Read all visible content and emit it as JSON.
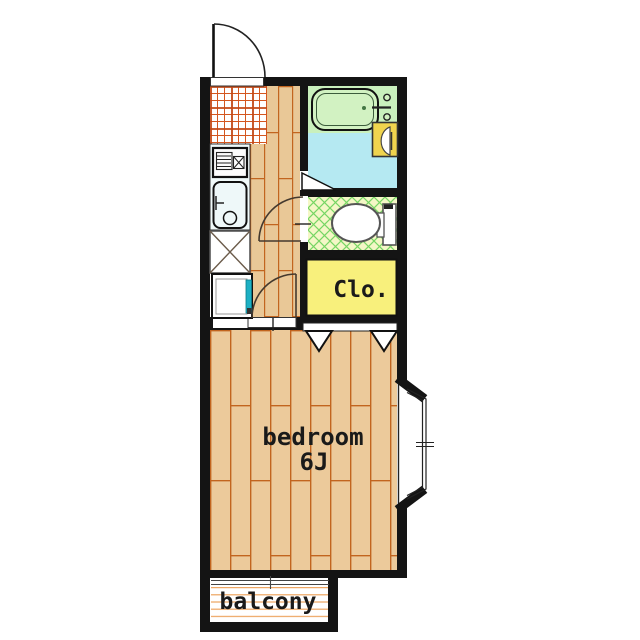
{
  "floor_plan": {
    "labels": {
      "bedroom_name": "bedroom",
      "bedroom_size": "6J",
      "closet": "Clo.",
      "balcony": "balcony"
    },
    "rooms": [
      {
        "name": "kitchen",
        "floor": "red tile grid"
      },
      {
        "name": "hallway",
        "floor": "wood planks"
      },
      {
        "name": "bathroom",
        "floor": "green / light blue"
      },
      {
        "name": "toilet-room",
        "floor": "green cross-hatch"
      },
      {
        "name": "closet",
        "label": "Clo.",
        "floor": "yellow"
      },
      {
        "name": "bedroom",
        "label": "bedroom 6J",
        "floor": "wood planks"
      },
      {
        "name": "balcony",
        "label": "balcony",
        "floor": "lined decking"
      }
    ],
    "fixtures": [
      "entrance-door",
      "bathtub",
      "bath-faucet",
      "washbasin",
      "toilet",
      "stove",
      "kitchen-sink",
      "refrigerator-space",
      "washing-machine-pan",
      "bay-window",
      "sliding-door",
      "closet-doors",
      "toilet-door",
      "bedroom-door",
      "bath-door"
    ],
    "colors": {
      "wall": "#141414",
      "wood_floor": "#ecca9b",
      "wood_seam": "#c2651f",
      "kitchen_tile_line": "#d4571f",
      "bath_floor": "#c9f0bd",
      "bathtub_fill": "#d2f2c2",
      "washroom_floor": "#b5e9f2",
      "toilet_floor": "#f4f7c6",
      "toilet_hatch": "#76d663",
      "closet_fill": "#f8f07c",
      "basin_fill": "#f0d44e",
      "washer_accent": "#1db0c4",
      "balcony_line": "#eda45f"
    }
  }
}
